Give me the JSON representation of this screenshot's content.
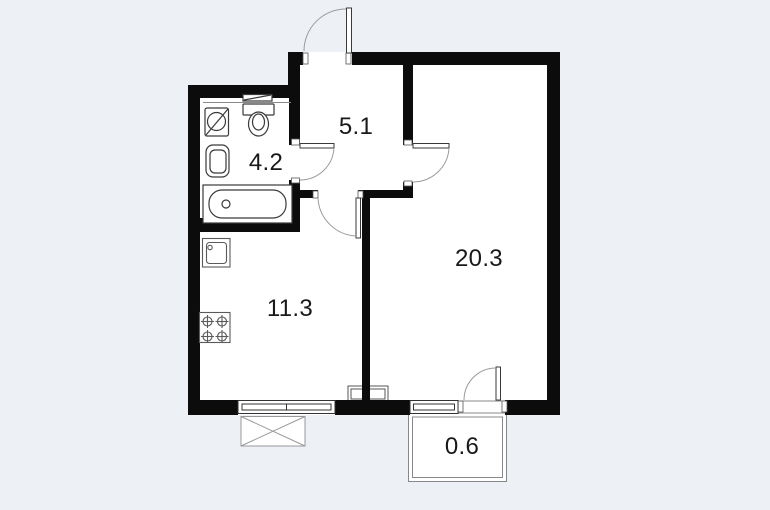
{
  "title": "Apartment floor plan",
  "rooms": [
    {
      "name": "bathroom",
      "area": "4.2"
    },
    {
      "name": "hallway",
      "area": "5.1"
    },
    {
      "name": "kitchen",
      "area": "11.3"
    },
    {
      "name": "living-room",
      "area": "20.3"
    },
    {
      "name": "balcony",
      "area": "0.6"
    }
  ],
  "colors": {
    "background": "#edf0f5",
    "wall": "#0c0c0c",
    "fixture_line": "#3a3a3a",
    "door_arc": "#9a9a9a",
    "label_text": "#191919"
  }
}
